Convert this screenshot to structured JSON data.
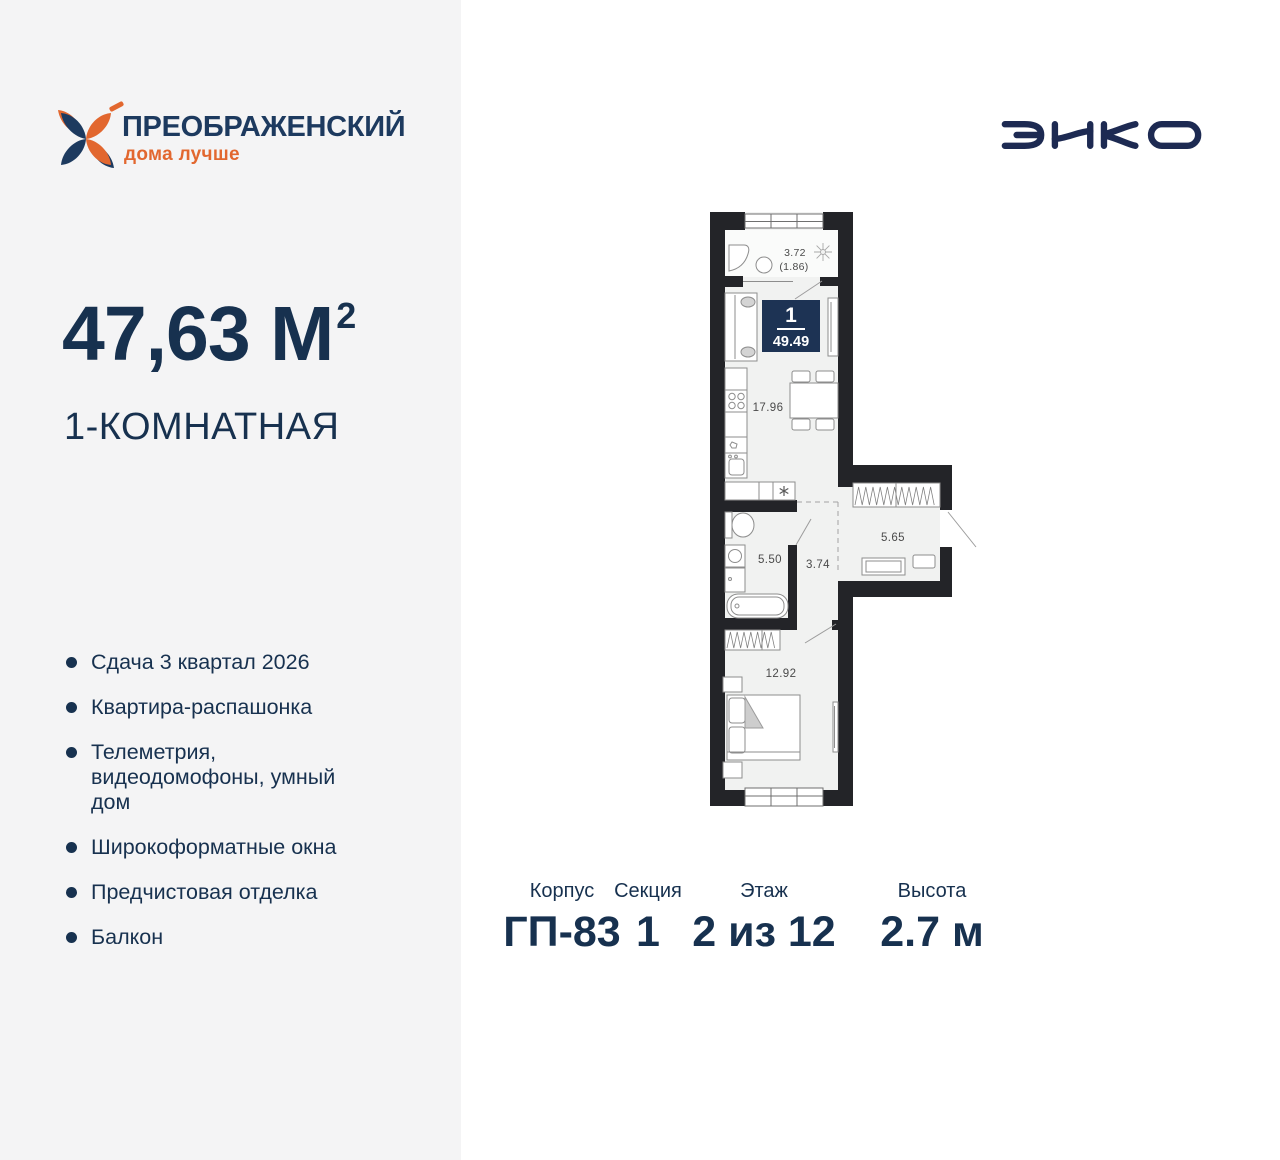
{
  "brand": {
    "name": "ПРЕОБРАЖЕНСКИЙ",
    "tagline": "дома лучше",
    "developer": "ЭНКО"
  },
  "listing": {
    "area_main": "47,63 М",
    "area_sup": "2",
    "type": "1-КОМНАТНАЯ",
    "features": [
      "Сдача 3 квартал 2026",
      "Квартира-распашонка",
      "Телеметрия, видеодомофоны, умный дом",
      "Широкоформатные окна",
      "Предчистовая отделка",
      "Балкон"
    ]
  },
  "plan": {
    "badge": {
      "rooms": "1",
      "total_area": "49.49"
    },
    "labels": {
      "balcony": "3.72",
      "balcony_reduced": "(1.86)",
      "kitchen_living": "17.96",
      "bathroom": "5.50",
      "hallway": "3.74",
      "entrance": "5.65",
      "bedroom": "12.92"
    }
  },
  "details": [
    {
      "label": "Корпус",
      "value": "ГП-83"
    },
    {
      "label": "Секция",
      "value": "1"
    },
    {
      "label": "Этаж",
      "value": "2 из 12"
    },
    {
      "label": "Высота",
      "value": "2.7 м"
    }
  ],
  "colors": {
    "navy": "#17314f",
    "orange": "#e2672f",
    "wall": "#232428",
    "floor": "#f1f2f1",
    "badge": "#1d3354",
    "panel": "#f4f4f5"
  }
}
